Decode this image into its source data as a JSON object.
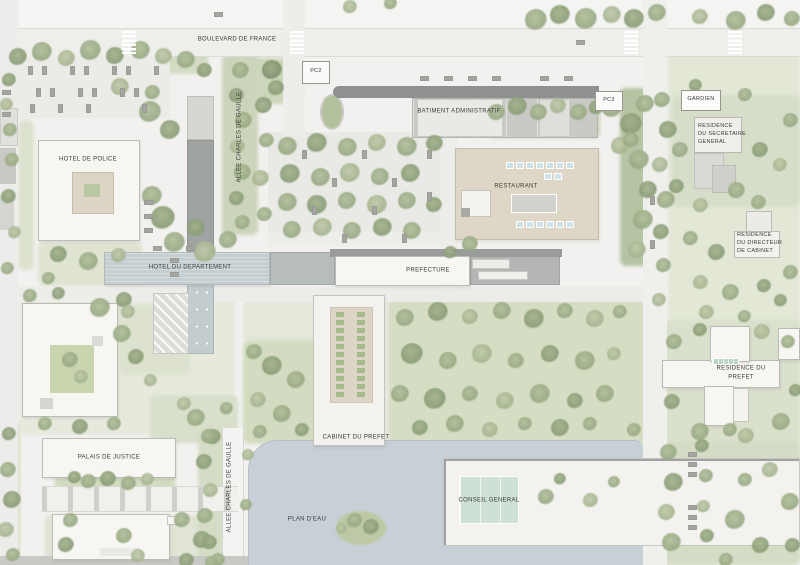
{
  "plan": {
    "title": "Prefecture complex site plan",
    "roads": {
      "boulevard_de_france": "BOULEVARD DE FRANCE",
      "allee_charles_de_gaulle_north": "ALLEE CHARLES DE GAULLE",
      "allee_charles_de_gaulle_south": "ALLEE CHARLES DE GAULLE"
    },
    "buildings": {
      "pc2": "PC2",
      "pc3": "PC3",
      "gardien": "GARDIEN",
      "batiment_administratif": "BATIMENT ADMINISTRATIF",
      "hotel_de_police": "HOTEL DE POLICE",
      "restaurant": "RESTAURANT",
      "residence_du_secretaire_general": "RESIDENCE\nDU SECRETAIRE\nGENERAL",
      "residence_du_directeur_de_cabinet": "RESIDENCE\nDU DIRECTEUR\nDE CABINET",
      "hotel_du_departement": "HOTEL DU DEPARTEMENT",
      "prefecture": "PREFECTURE",
      "residence_du_prefet": "RESIDENCE DU PREFET",
      "cabinet_du_prefet": "CABINET DU PREFET",
      "palais_de_justice": "PALAIS DE JUSTICE",
      "conseil_general": "CONSEIL GENERAL"
    },
    "water": {
      "plan_deau": "PLAN D'EAU"
    },
    "colors": {
      "background": "#f2f1ef",
      "lawn": "#d7dfc8",
      "tree": "#9cab88",
      "water": "#c7d0d6",
      "building_white": "#f7f6f3",
      "building_grey": "#b3b6b5",
      "building_beige": "#ded6c7",
      "roof_dark": "#8e9190",
      "band_blue": "#c5ced1",
      "teal_roof": "#cfe0d7",
      "label_text": "#3a3a38"
    }
  }
}
